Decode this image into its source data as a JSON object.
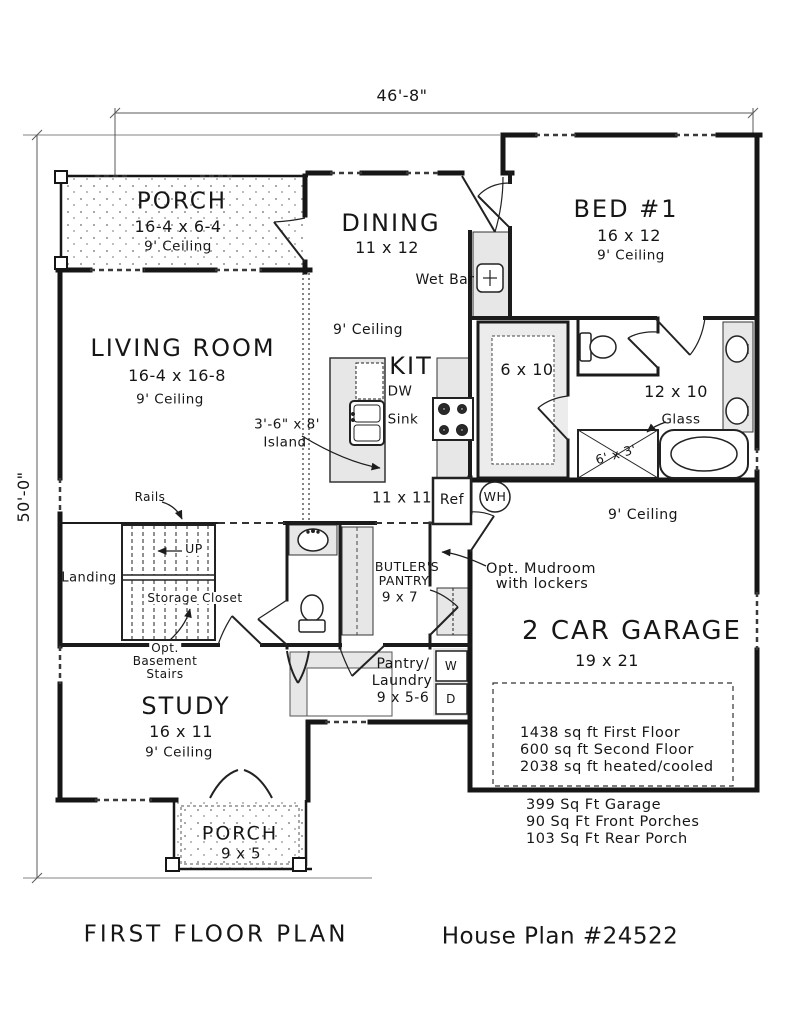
{
  "meta": {
    "plan_title": "FIRST FLOOR PLAN",
    "plan_number": "House Plan #24522"
  },
  "dimensions": {
    "overall_width": "46'-8\"",
    "overall_height": "50'-0\""
  },
  "rooms": {
    "front_porch": {
      "name": "PORCH",
      "size": "16-4 x 6-4",
      "ceiling": "9' Ceiling"
    },
    "dining": {
      "name": "DINING",
      "size": "11 x 12"
    },
    "bed1": {
      "name": "BED #1",
      "size": "16 x 12",
      "ceiling": "9' Ceiling"
    },
    "living_room": {
      "name": "LIVING ROOM",
      "size": "16-4 x 16-8",
      "ceiling": "9' Ceiling"
    },
    "kitchen": {
      "name": "KIT",
      "size": "11 x 11",
      "ceiling": "9' Ceiling"
    },
    "closet": {
      "size": "6 x 10"
    },
    "bath": {
      "size": "12 x 10"
    },
    "shower": {
      "size": "6' x 3'"
    },
    "garage": {
      "name": "2 CAR GARAGE",
      "size": "19 x 21",
      "ceiling": "9' Ceiling"
    },
    "butlers_pantry": {
      "name_line1": "BUTLER'S",
      "name_line2": "PANTRY",
      "size": "9 x 7"
    },
    "pantry_laundry": {
      "name_line1": "Pantry/",
      "name_line2": "Laundry",
      "size": "9 x 5-6"
    },
    "study": {
      "name": "STUDY",
      "size": "16 x 11",
      "ceiling": "9' Ceiling"
    },
    "rear_porch": {
      "name": "PORCH",
      "size": "9 x 5"
    },
    "landing": {
      "name": "Landing"
    },
    "storage_closet": {
      "name": "Storage Closet"
    }
  },
  "annotations": {
    "wet_bar": "Wet Bar",
    "island_size": "3'-6\" x 8'",
    "island": "Island",
    "dishwasher": "DW",
    "sink": "Sink",
    "refrigerator": "Ref",
    "water_heater": "WH",
    "rails": "Rails",
    "up": "UP",
    "opt_basement_1": "Opt.",
    "opt_basement_2": "Basement",
    "opt_basement_3": "Stairs",
    "mudroom_1": "Opt. Mudroom",
    "mudroom_2": "with lockers",
    "glass": "Glass",
    "washer": "W",
    "dryer": "D"
  },
  "area_summary": {
    "heated": [
      "1438 sq ft First Floor",
      "600 sq ft Second Floor",
      "2038 sq ft heated/cooled"
    ],
    "unheated": [
      "399 Sq Ft Garage",
      "90 Sq Ft Front Porches",
      "103 Sq Ft Rear Porch"
    ]
  },
  "colors": {
    "wall": "#161616",
    "fill_light": "#e7e7e7",
    "paper": "#ffffff",
    "dimension": "#555555"
  }
}
